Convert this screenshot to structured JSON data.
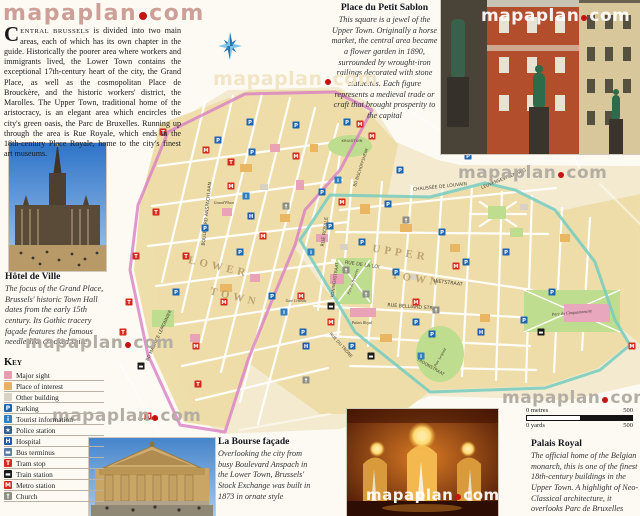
{
  "logo": {
    "name": "mapaplan",
    "tld": "com"
  },
  "watermark": {
    "name": "mapaplan",
    "tld": "com"
  },
  "intro": {
    "dropcap": "C",
    "lead": "ENTRAL BRUSSELS",
    "body": " is divided into two main areas, each of which has its own chapter in the guide. Historically the poorer area where workers and immigrants lived, the Lower Town contains the exceptional 17th-century heart of the city, the Grand Place, as well as the cosmopolitan Place de Brouckère, and the historic workers' district, the Marolles. The Upper Town, traditional home of the aristocracy, is an elegant area which encircles the city's green oasis, the Parc de Bruxelles. Running up through the area is Rue Royale, which ends in the 18th-century Place Royale, home to the city's finest art museums."
  },
  "articles": {
    "petit_sablon": {
      "title": "Place du Petit Sablon",
      "body": "This square is a jewel of the Upper Town. Originally a horse market, the central area became a flower garden in 1890, surrounded by wrought-iron railings decorated with stone statuettes. Each figure represents a medieval trade or craft that brought prosperity to the capital"
    },
    "hotel_de_ville": {
      "title": "Hôtel de Ville",
      "body": "The focus of the Grand Place, Brussels' historic Town Hall dates from the early 15th century. Its Gothic tracery façade features the famous needle-like crooked spire"
    },
    "la_bourse": {
      "title": "La Bourse façade",
      "body": "Overlooking the city from busy Boulevard Anspach in the Lower Town, Brussels' Stock Exchange was built in 1873 in ornate style"
    },
    "palais_royal": {
      "title": "Palais Royal",
      "body": "The official home of the Belgian monarch, this is one of the finest 18th-century buildings in the Upper Town. A highlight of Neo-Classical architecture, it overlooks Parc de Bruxelles"
    }
  },
  "key": {
    "title": "Key",
    "items": [
      {
        "label": "Major sight",
        "bg": "#e89cb0",
        "pattern": true
      },
      {
        "label": "Place of interest",
        "bg": "#e8b163",
        "pattern": true
      },
      {
        "label": "Other building",
        "bg": "#d9d2c6",
        "pattern": true
      },
      {
        "label": "Parking",
        "glyph": "P",
        "bg": "#1f66b0",
        "fg": "#ffffff"
      },
      {
        "label": "Tourist information",
        "glyph": "i",
        "bg": "#2f7fc0",
        "fg": "#ffffff"
      },
      {
        "label": "Police station",
        "glyph": "★",
        "bg": "#35618f",
        "fg": "#ffffff"
      },
      {
        "label": "Hospital",
        "glyph": "H",
        "bg": "#2458a8",
        "fg": "#ffffff"
      },
      {
        "label": "Bus terminus",
        "glyph": "▬",
        "bg": "#5a7fa8",
        "fg": "#ffffff"
      },
      {
        "label": "Tram stop",
        "glyph": "T",
        "bg": "#d42b20",
        "fg": "#ffffff"
      },
      {
        "label": "Train station",
        "glyph": "▬",
        "bg": "#1a1a1a",
        "fg": "#ffffff"
      },
      {
        "label": "Metro station",
        "glyph": "M",
        "bg": "#d42b20",
        "fg": "#ffffff"
      },
      {
        "label": "Church",
        "glyph": "†",
        "bg": "#8f8f86",
        "fg": "#ffffff"
      }
    ]
  },
  "scale": {
    "metres_zero": "0 metres",
    "metres_max": "500",
    "yards_zero": "0 yards",
    "yards_max": "500"
  },
  "map": {
    "boundary_colors": {
      "lower_town": "#d97fc4",
      "upper_town": "#74cdbf"
    },
    "area_labels": [
      {
        "text": "LOWER",
        "x": 118,
        "y": 186,
        "rot": 13
      },
      {
        "text": "TOWN",
        "x": 134,
        "y": 216,
        "rot": 13
      },
      {
        "text": "UPPER",
        "x": 300,
        "y": 172,
        "rot": 9
      },
      {
        "text": "TOWN",
        "x": 316,
        "y": 198,
        "rot": 9
      }
    ],
    "street_labels": [
      {
        "text": "BOULEVARD ANSPACHLAAN",
        "x": 108,
        "y": 130,
        "rot": -84,
        "size": 4.6
      },
      {
        "text": "BD MAURICE LEMONNIER",
        "x": 60,
        "y": 252,
        "rot": -65,
        "size": 4.4
      },
      {
        "text": "RUE ROYALE",
        "x": 226,
        "y": 148,
        "rot": -82,
        "size": 4.8
      },
      {
        "text": "KONINGSSTRAAT",
        "x": 236,
        "y": 196,
        "rot": -82,
        "size": 4.2
      },
      {
        "text": "RUE DE LA LOI",
        "x": 262,
        "y": 182,
        "rot": 8,
        "size": 4.8
      },
      {
        "text": "WETSTRAAT",
        "x": 348,
        "y": 200,
        "rot": 7,
        "size": 4.8
      },
      {
        "text": "RUE BELLIARD STR",
        "x": 310,
        "y": 224,
        "rot": 4,
        "size": 4.8
      },
      {
        "text": "CHAUSSÉE DE LOUVAIN",
        "x": 340,
        "y": 104,
        "rot": -6,
        "size": 4.6
      },
      {
        "text": "LEUVENSESTEENWEG",
        "x": 404,
        "y": 96,
        "rot": -22,
        "size": 4.4
      },
      {
        "text": "RUE DU TRONE",
        "x": 240,
        "y": 262,
        "rot": 48,
        "size": 4.2
      },
      {
        "text": "TROONSTRAAT",
        "x": 330,
        "y": 284,
        "rot": 30,
        "size": 4.2
      },
      {
        "text": "BD BISCHOFFSHEIM",
        "x": 262,
        "y": 84,
        "rot": -72,
        "size": 4.0
      },
      {
        "text": "KRUIDTUIN",
        "x": 252,
        "y": 58,
        "rot": 0,
        "size": 3.8
      }
    ],
    "place_labels": [
      {
        "text": "Grand'Place",
        "x": 124,
        "y": 120,
        "rot": 0,
        "size": 4.0
      },
      {
        "text": "Palais Royal",
        "x": 262,
        "y": 240,
        "rot": 0,
        "size": 4.0
      },
      {
        "text": "Parc de Bruxelles",
        "x": 254,
        "y": 198,
        "rot": -70,
        "size": 3.8
      },
      {
        "text": "Parc Leopold",
        "x": 341,
        "y": 274,
        "rot": -60,
        "size": 3.8
      },
      {
        "text": "Parc du Cinquantenaire",
        "x": 472,
        "y": 230,
        "rot": -5,
        "size": 4.2
      },
      {
        "text": "Gare Centrale",
        "x": 196,
        "y": 218,
        "rot": 0,
        "size": 3.6
      },
      {
        "text": "Gare du Midi",
        "x": 48,
        "y": 336,
        "rot": 0,
        "size": 3.8
      }
    ],
    "icon_types": {
      "p": {
        "glyph": "P",
        "bg": "#1f66b0"
      },
      "m": {
        "glyph": "M",
        "bg": "#d42b20"
      },
      "i": {
        "glyph": "i",
        "bg": "#2f7fc0"
      },
      "h": {
        "glyph": "H",
        "bg": "#2458a8"
      },
      "t": {
        "glyph": "T",
        "bg": "#d42b20"
      },
      "r": {
        "glyph": "▬",
        "bg": "#1a1a1a"
      },
      "c": {
        "glyph": "†",
        "bg": "#8f8f86"
      }
    },
    "icons": [
      [
        "p",
        118,
        56
      ],
      [
        "p",
        152,
        68
      ],
      [
        "p",
        196,
        41
      ],
      [
        "p",
        247,
        38
      ],
      [
        "p",
        105,
        144
      ],
      [
        "p",
        140,
        168
      ],
      [
        "p",
        172,
        212
      ],
      [
        "p",
        230,
        142
      ],
      [
        "p",
        262,
        158
      ],
      [
        "p",
        296,
        188
      ],
      [
        "p",
        342,
        148
      ],
      [
        "p",
        366,
        178
      ],
      [
        "p",
        406,
        168
      ],
      [
        "p",
        452,
        208
      ],
      [
        "p",
        316,
        238
      ],
      [
        "p",
        252,
        262
      ],
      [
        "p",
        203,
        248
      ],
      [
        "p",
        76,
        208
      ],
      [
        "p",
        368,
        72
      ],
      [
        "p",
        300,
        86
      ],
      [
        "p",
        424,
        236
      ],
      [
        "p",
        150,
        38
      ],
      [
        "p",
        222,
        108
      ],
      [
        "p",
        288,
        120
      ],
      [
        "p",
        332,
        250
      ],
      [
        "m",
        106,
        66
      ],
      [
        "m",
        131,
        102
      ],
      [
        "m",
        163,
        152
      ],
      [
        "m",
        196,
        72
      ],
      [
        "m",
        242,
        118
      ],
      [
        "m",
        201,
        212
      ],
      [
        "m",
        231,
        238
      ],
      [
        "m",
        316,
        218
      ],
      [
        "m",
        356,
        182
      ],
      [
        "m",
        532,
        262
      ],
      [
        "m",
        48,
        332
      ],
      [
        "m",
        272,
        52
      ],
      [
        "m",
        124,
        218
      ],
      [
        "m",
        260,
        40
      ],
      [
        "m",
        96,
        262
      ],
      [
        "i",
        146,
        112
      ],
      [
        "i",
        211,
        168
      ],
      [
        "i",
        184,
        228
      ],
      [
        "i",
        321,
        272
      ],
      [
        "i",
        238,
        96
      ],
      [
        "h",
        151,
        132
      ],
      [
        "h",
        206,
        262
      ],
      [
        "h",
        381,
        248
      ],
      [
        "t",
        56,
        128
      ],
      [
        "t",
        36,
        172
      ],
      [
        "t",
        86,
        172
      ],
      [
        "t",
        131,
        78
      ],
      [
        "t",
        29,
        218
      ],
      [
        "t",
        63,
        48
      ],
      [
        "t",
        23,
        248
      ],
      [
        "t",
        98,
        300
      ],
      [
        "r",
        231,
        222
      ],
      [
        "r",
        41,
        282
      ],
      [
        "r",
        271,
        272
      ],
      [
        "r",
        441,
        248
      ],
      [
        "c",
        186,
        122
      ],
      [
        "c",
        246,
        186
      ],
      [
        "c",
        306,
        136
      ],
      [
        "c",
        206,
        296
      ],
      [
        "c",
        336,
        226
      ],
      [
        "c",
        266,
        210
      ]
    ]
  }
}
